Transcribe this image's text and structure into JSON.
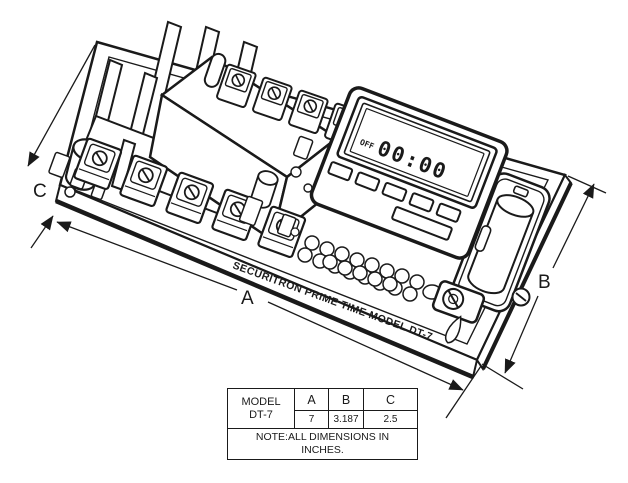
{
  "drawing": {
    "board_edge_text": "SECURITRON PRIME TIME MODEL DT-7",
    "lcd": {
      "off_label": "OFF",
      "time_value": "00:00"
    },
    "dim_a_label": "A",
    "dim_b_label": "B",
    "dim_c_label": "C"
  },
  "spec_table": {
    "model_line1": "MODEL",
    "model_line2": "DT-7",
    "columns": [
      "A",
      "B",
      "C"
    ],
    "values": [
      "7",
      "3.187",
      "2.5"
    ],
    "note_line1": "NOTE:ALL DIMENSIONS IN",
    "note_line2": "INCHES."
  },
  "colors": {
    "ink": "#1a1a1a",
    "paper": "#ffffff"
  }
}
